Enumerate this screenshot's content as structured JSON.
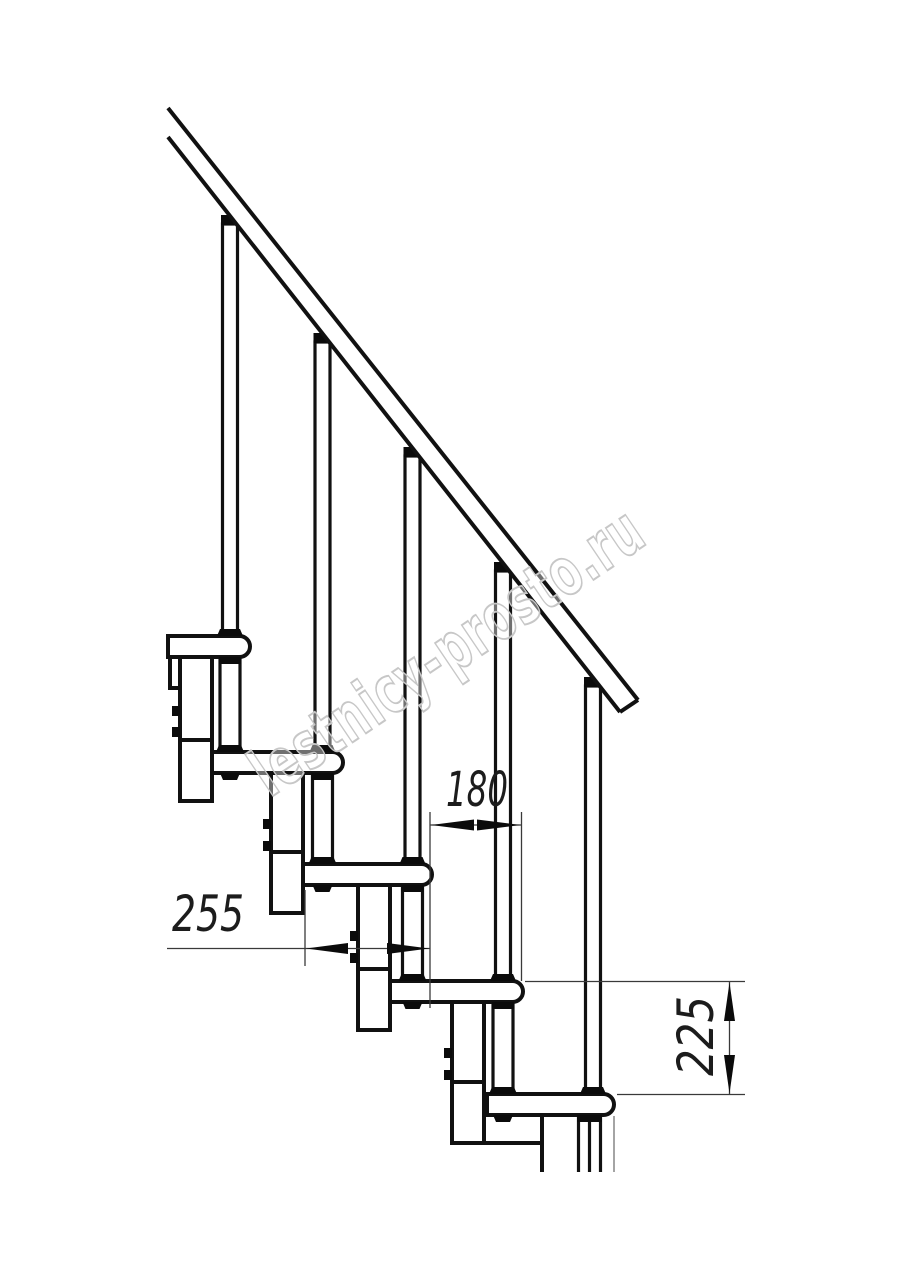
{
  "drawing": {
    "kind": "modular staircase side-view technical drawing",
    "line_color": "#111111",
    "background": "#ffffff"
  },
  "dimensions": {
    "run": "180",
    "depth": "255",
    "height": "225"
  },
  "watermark": {
    "text": "lestnicy-prosto.ru",
    "color": "#c7c7c7"
  }
}
